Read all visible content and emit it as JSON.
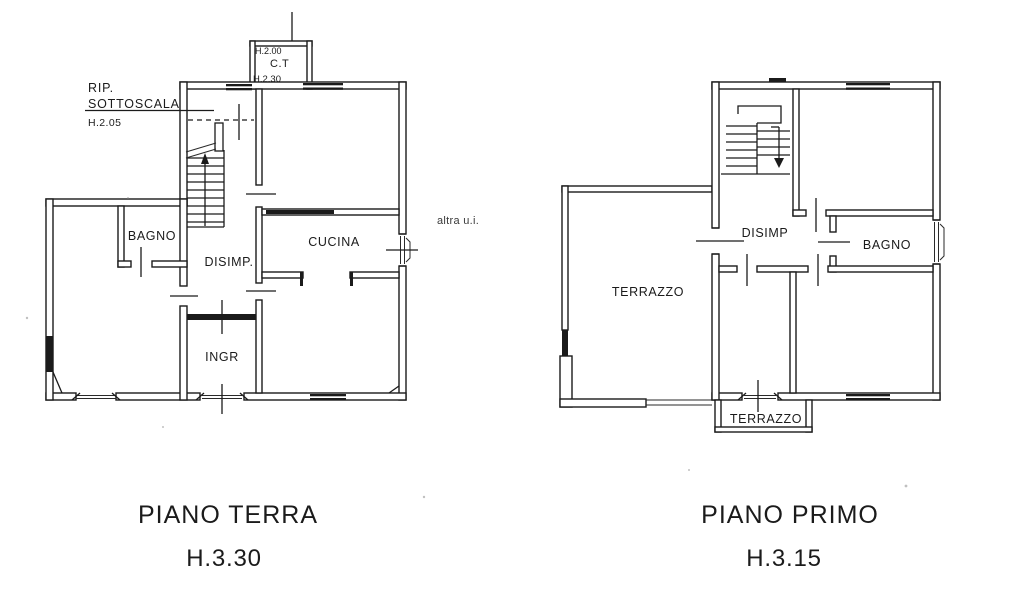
{
  "scan": {
    "ink": "#1b1b1b",
    "paper": "#ffffff"
  },
  "ground_floor": {
    "title": "PIANO TERRA",
    "height_label": "H.3.30",
    "annotations": {
      "rip": "RIP.",
      "sottoscala": "SOTTOSCALA",
      "rip_height": "H.2.05",
      "altra_ui": "altra u.i."
    },
    "ct_box": {
      "height_top": "H.2.00",
      "name": "C.T",
      "height_bottom": "H.2.30"
    },
    "rooms": {
      "bagno": "BAGNO",
      "disimp": "DISIMP.",
      "cucina": "CUCINA",
      "ingr": "INGR"
    }
  },
  "first_floor": {
    "title": "PIANO PRIMO",
    "height_label": "H.3.15",
    "rooms": {
      "terrazzo": "TERRAZZO",
      "disimp": "DISIMP",
      "bagno": "BAGNO",
      "terrazzo_bottom": "TERRAZZO"
    }
  }
}
